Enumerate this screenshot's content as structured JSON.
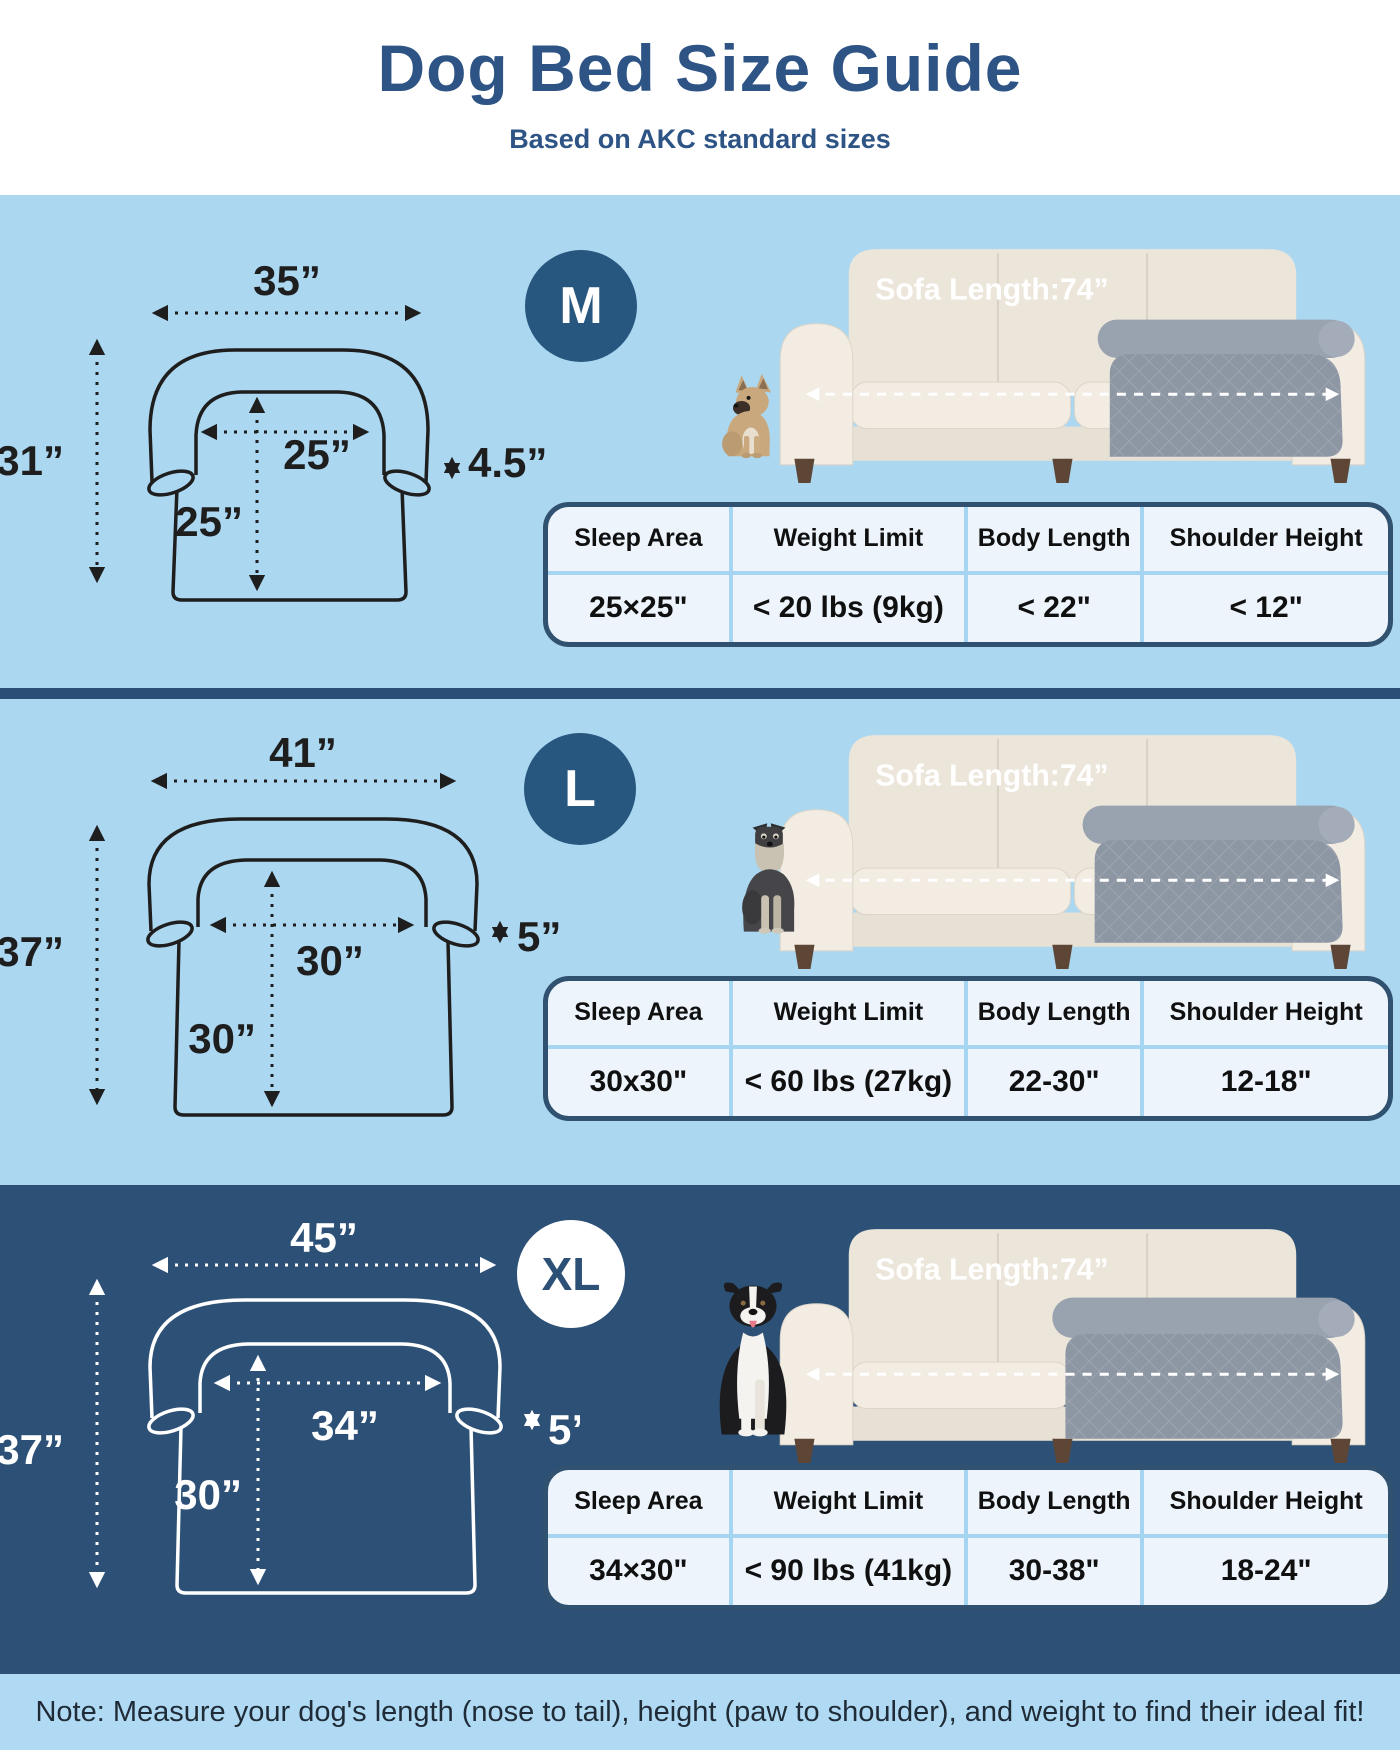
{
  "header": {
    "title": "Dog Bed Size Guide",
    "subtitle": "Based on AKC standard sizes"
  },
  "sections": [
    {
      "badge": "M",
      "dog": "french-bulldog",
      "sofa_label": "Sofa Length:74”",
      "dims": {
        "width": "35”",
        "height": "31”",
        "inner_width": "25”",
        "inner_height": "25”",
        "bolster": "4.5”"
      },
      "table": {
        "headers": [
          "Sleep Area",
          "Weight Limit",
          "Body Length",
          "Shoulder Height"
        ],
        "values": [
          "25×25\"",
          "< 20 lbs (9kg)",
          "< 22\"",
          "< 12\""
        ]
      }
    },
    {
      "badge": "L",
      "dog": "schnauzer",
      "sofa_label": "Sofa Length:74”",
      "dims": {
        "width": "41”",
        "height": "37”",
        "inner_width": "30”",
        "inner_height": "30”",
        "bolster": "5”"
      },
      "table": {
        "headers": [
          "Sleep Area",
          "Weight Limit",
          "Body Length",
          "Shoulder Height"
        ],
        "values": [
          "30x30\"",
          "< 60 lbs (27kg)",
          "22-30\"",
          "12-18\""
        ]
      }
    },
    {
      "badge": "XL",
      "dog": "border-collie",
      "sofa_label": "Sofa Length:74”",
      "dims": {
        "width": "45”",
        "height": "37”",
        "inner_width": "34”",
        "inner_height": "30”",
        "bolster": "5”"
      },
      "table": {
        "headers": [
          "Sleep Area",
          "Weight Limit",
          "Body Length",
          "Shoulder Height"
        ],
        "values": [
          "34×30\"",
          "< 90 lbs (41kg)",
          "30-38\"",
          "18-24\""
        ]
      }
    }
  ],
  "footer": {
    "note": "Note: Measure your dog's length (nose to tail), height (paw to shoulder), and weight to find their ideal fit!"
  },
  "colors": {
    "title": "#2d5485",
    "light_section_bg": "#abd7f1",
    "dark_section_bg": "#2d5176",
    "badge": "#27567e",
    "table_border": "#30516f",
    "table_divider": "#a5d5f1"
  }
}
